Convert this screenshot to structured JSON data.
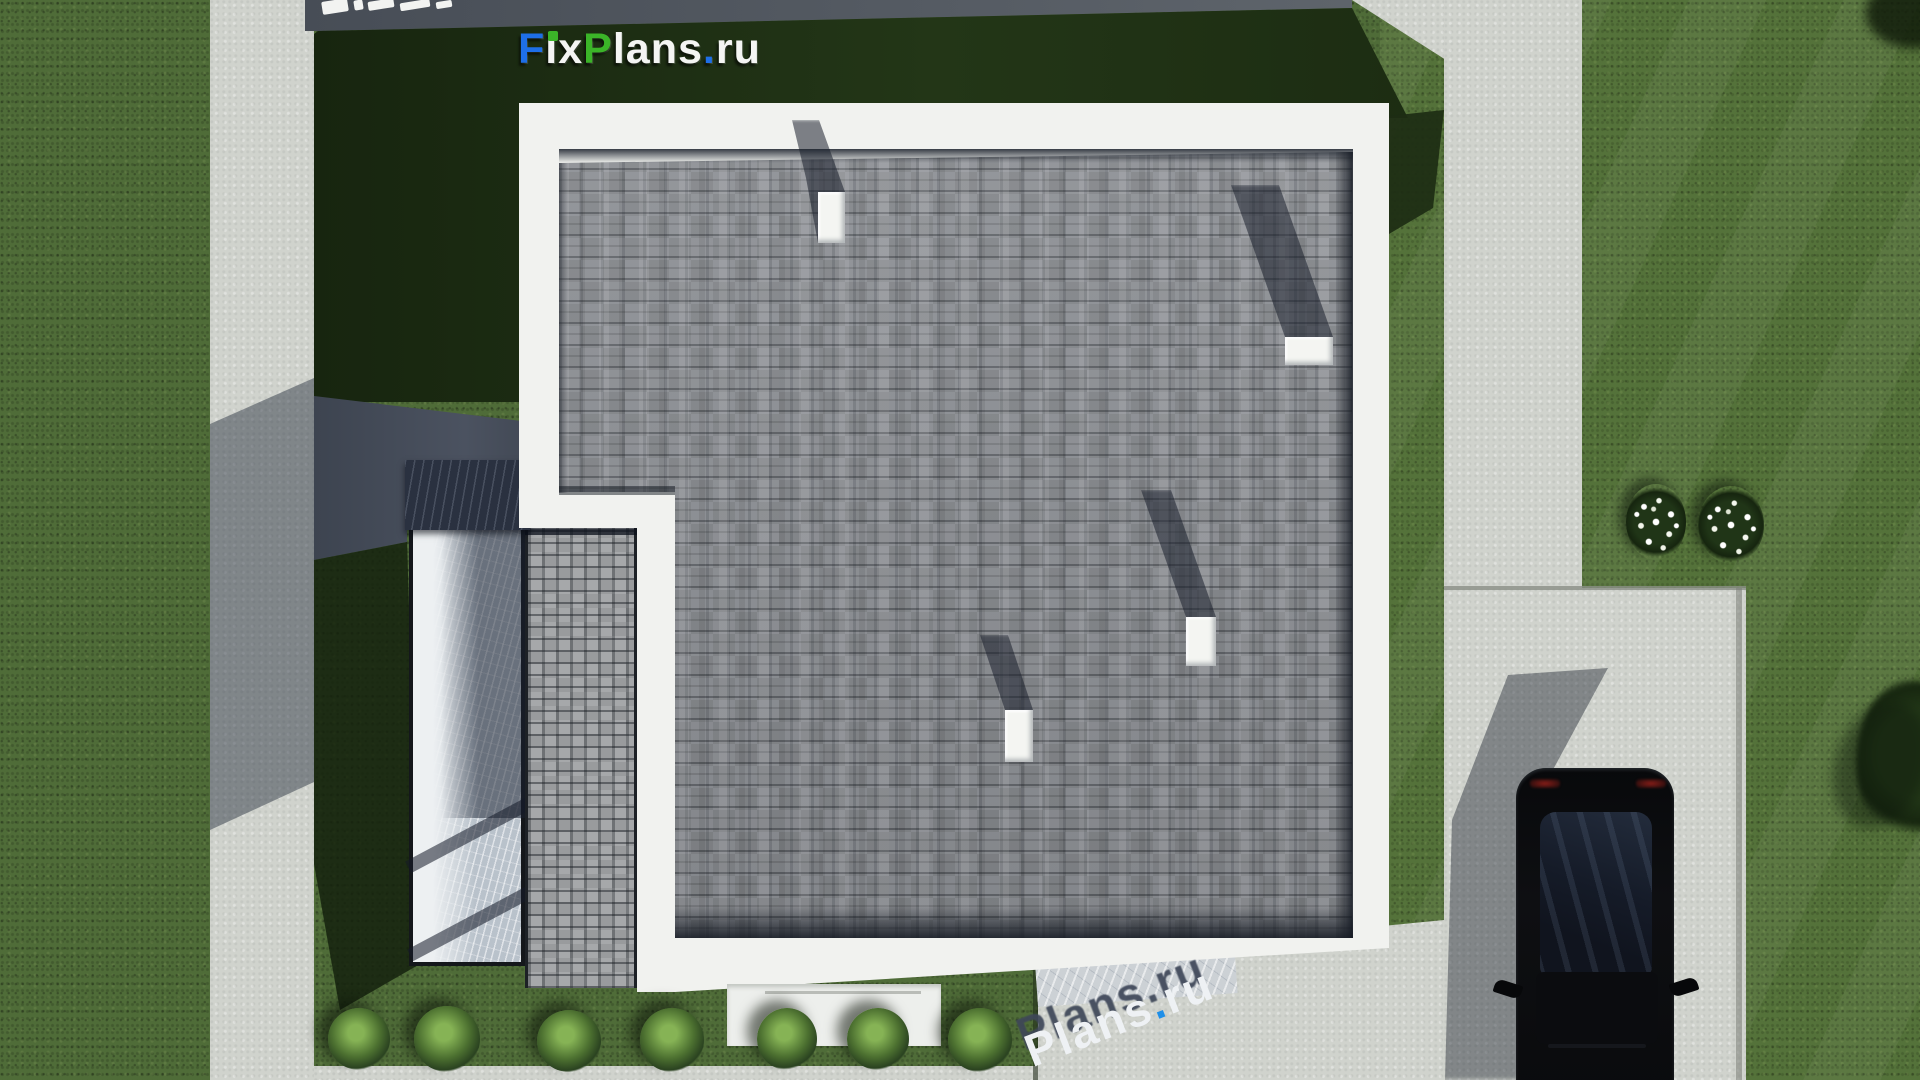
{
  "meta": {
    "description": "Aerial top-down 3D architectural render of a flat-roof house plan (roof view) on a landscaped lot with driveway, car, terrace and lawn",
    "source_branding": "FixPlans.ru",
    "canvas": {
      "width": 1920,
      "height": 1080
    }
  },
  "branding": {
    "logo": {
      "text": "FixPlans.ru",
      "parts": [
        {
          "t": "F",
          "color": "#1e6fe8"
        },
        {
          "t": "i",
          "color": "#f4f5f3",
          "dot_color": "#3bb428"
        },
        {
          "t": "x",
          "color": "#f4f5f3"
        },
        {
          "t": "P",
          "color": "#3bb428"
        },
        {
          "t": "lans",
          "color": "#f4f5f3"
        },
        {
          "t": ".",
          "color": "#1e6fe8"
        },
        {
          "t": "ru",
          "color": "#f4f5f3"
        }
      ]
    },
    "watermark_bottom": {
      "text": "Plans.ru",
      "parts": {
        "word1": "Plans",
        "dot": ".",
        "word2": "ru"
      },
      "style": "3d-extruded white letters with dark cast shadow, blue dot",
      "rotation_deg": -21
    },
    "watermark_top": {
      "note": "white 3D letter fragments cut off at top edge of image"
    }
  },
  "scene": {
    "roof": {
      "type": "flat roof with gray asphalt shingles and white parapet",
      "chimneys": 4,
      "chimney_color": "#f4f5f2",
      "shadow_direction": "up-left"
    },
    "left_wing": {
      "terrace": "marble deck with pergola beam and slatted shadow",
      "roof_strip": "light gray shingles"
    },
    "landscape": {
      "lawn_color": "#4f6c38",
      "bushes_bottom_row": 7,
      "flower_beds_right": 2,
      "tree_right_edge": 1
    },
    "hardscape": {
      "left_path": "light concrete, partly in building shadow",
      "top_road": "dark shaded pavement strip",
      "right_walkway_and_car_pad": "light concrete",
      "bottom_sidewalk": "light concrete strip"
    },
    "car": {
      "color": "black",
      "view": "top-down, parked on right pad, front cut by bottom edge",
      "mirrors": 2,
      "taillights": 2
    }
  },
  "colors": {
    "grass": "#4f6c38",
    "grass_shadow": "#1c2c12",
    "concrete": "#d0d3cd",
    "shaded_pavement": "#50565e",
    "parapet_white": "#f1f2ef",
    "shingle_gray": "#8d9095",
    "wing_shingle": "#a6a8aa",
    "marble": "#b9c2cb",
    "pergola_beam": "#2a3140",
    "car_body": "#0a0b0d",
    "car_glass": "#1a2230",
    "logo_blue": "#1e6fe8",
    "logo_green": "#3bb428",
    "watermark_blue": "#1f8fe8"
  }
}
